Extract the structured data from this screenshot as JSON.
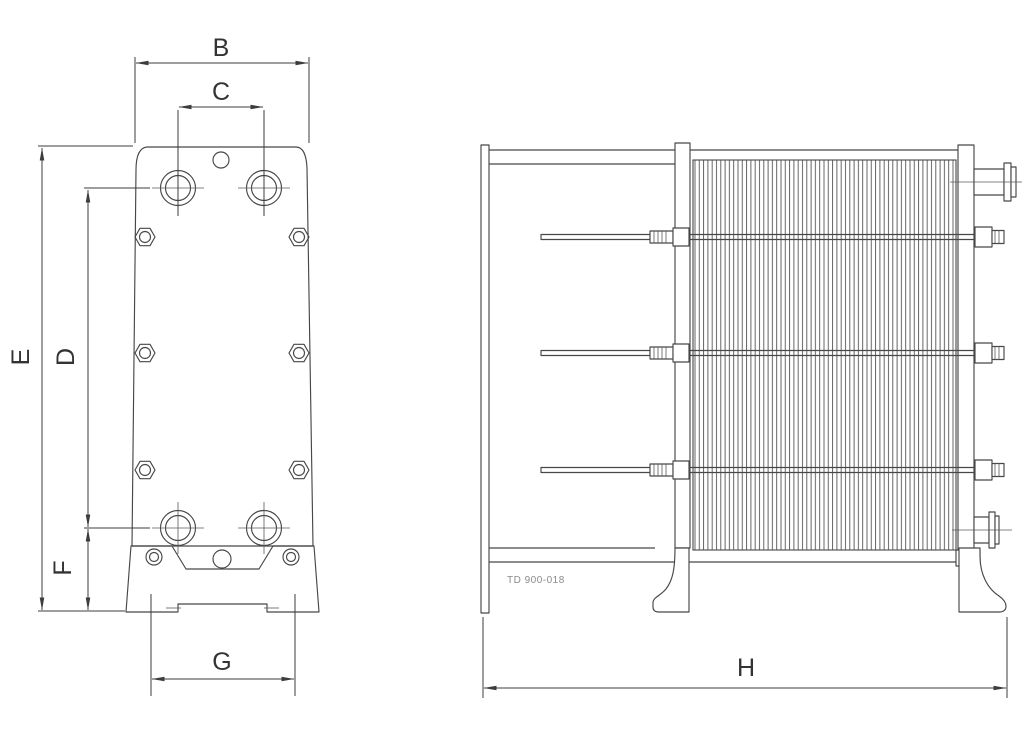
{
  "page": {
    "background": "#ffffff",
    "line_color": "#474747",
    "dimension_line_color": "#3d3d3d",
    "label_color": "#333333",
    "code_color": "#8a8a8a"
  },
  "dimension_labels": {
    "B": "B",
    "C": "C",
    "D": "D",
    "E": "E",
    "F": "F",
    "G": "G",
    "H": "H"
  },
  "drawing_code": "TD 900-018"
}
